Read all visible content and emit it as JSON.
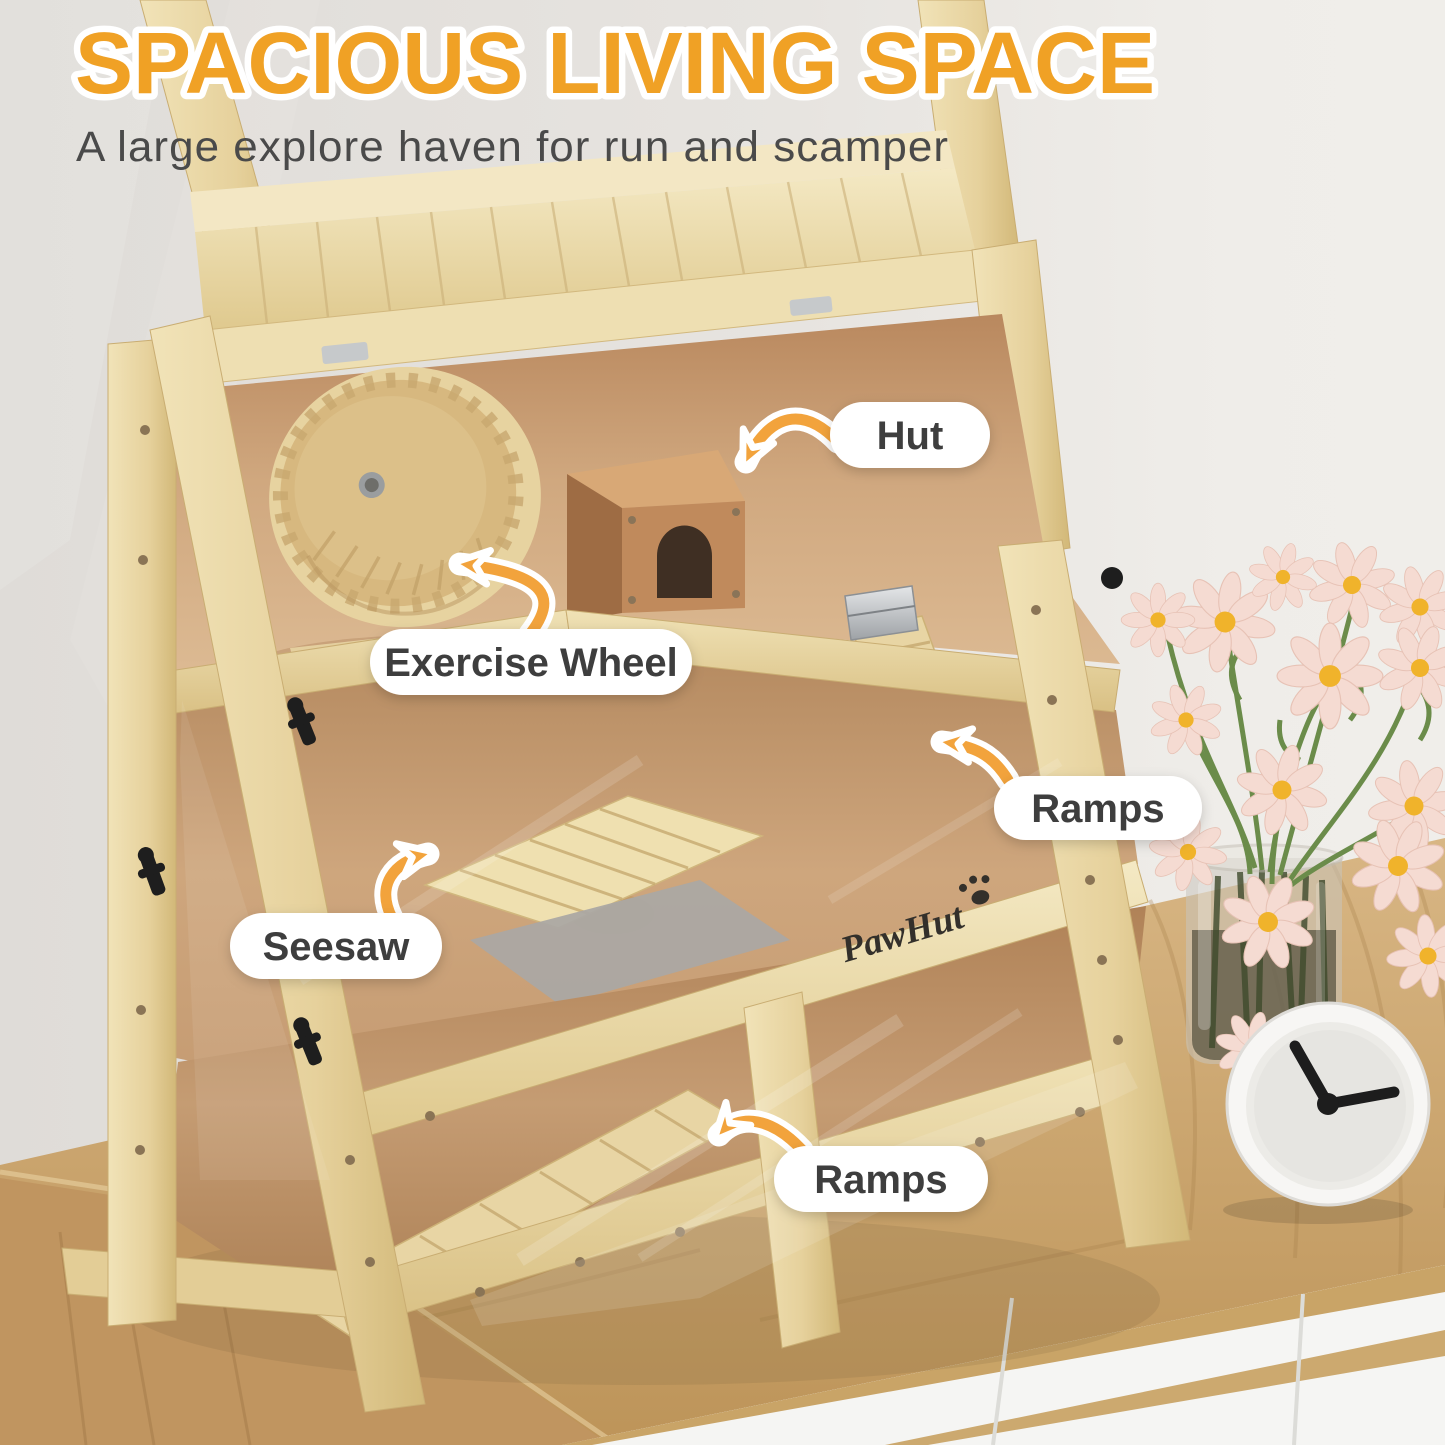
{
  "header": {
    "title": "SPACIOUS LIVING SPACE",
    "subtitle": "A large explore haven for run and scamper"
  },
  "annotations": {
    "hut": {
      "label": "Hut"
    },
    "exercise_wheel": {
      "label": "Exercise Wheel"
    },
    "ramps_upper": {
      "label": "Ramps"
    },
    "seesaw": {
      "label": "Seesaw"
    },
    "ramps_lower": {
      "label": "Ramps"
    }
  },
  "brand": {
    "logo": "PawHut"
  },
  "colors": {
    "title_orange": "#F0A125",
    "subtitle_gray": "#4A4A4A",
    "arrow_orange": "#F2A33C",
    "label_bg": "#FFFFFF",
    "label_text": "#3E3E3E",
    "wood_light": "#EBD9A8",
    "interior_tan": "#C9A07A",
    "hut_brown": "#C08A5C",
    "wall_gray": "#E5E2DE",
    "flower_petal": "#F5DBD2",
    "flower_center": "#F0B32B",
    "stem_green": "#6B8C4A"
  }
}
